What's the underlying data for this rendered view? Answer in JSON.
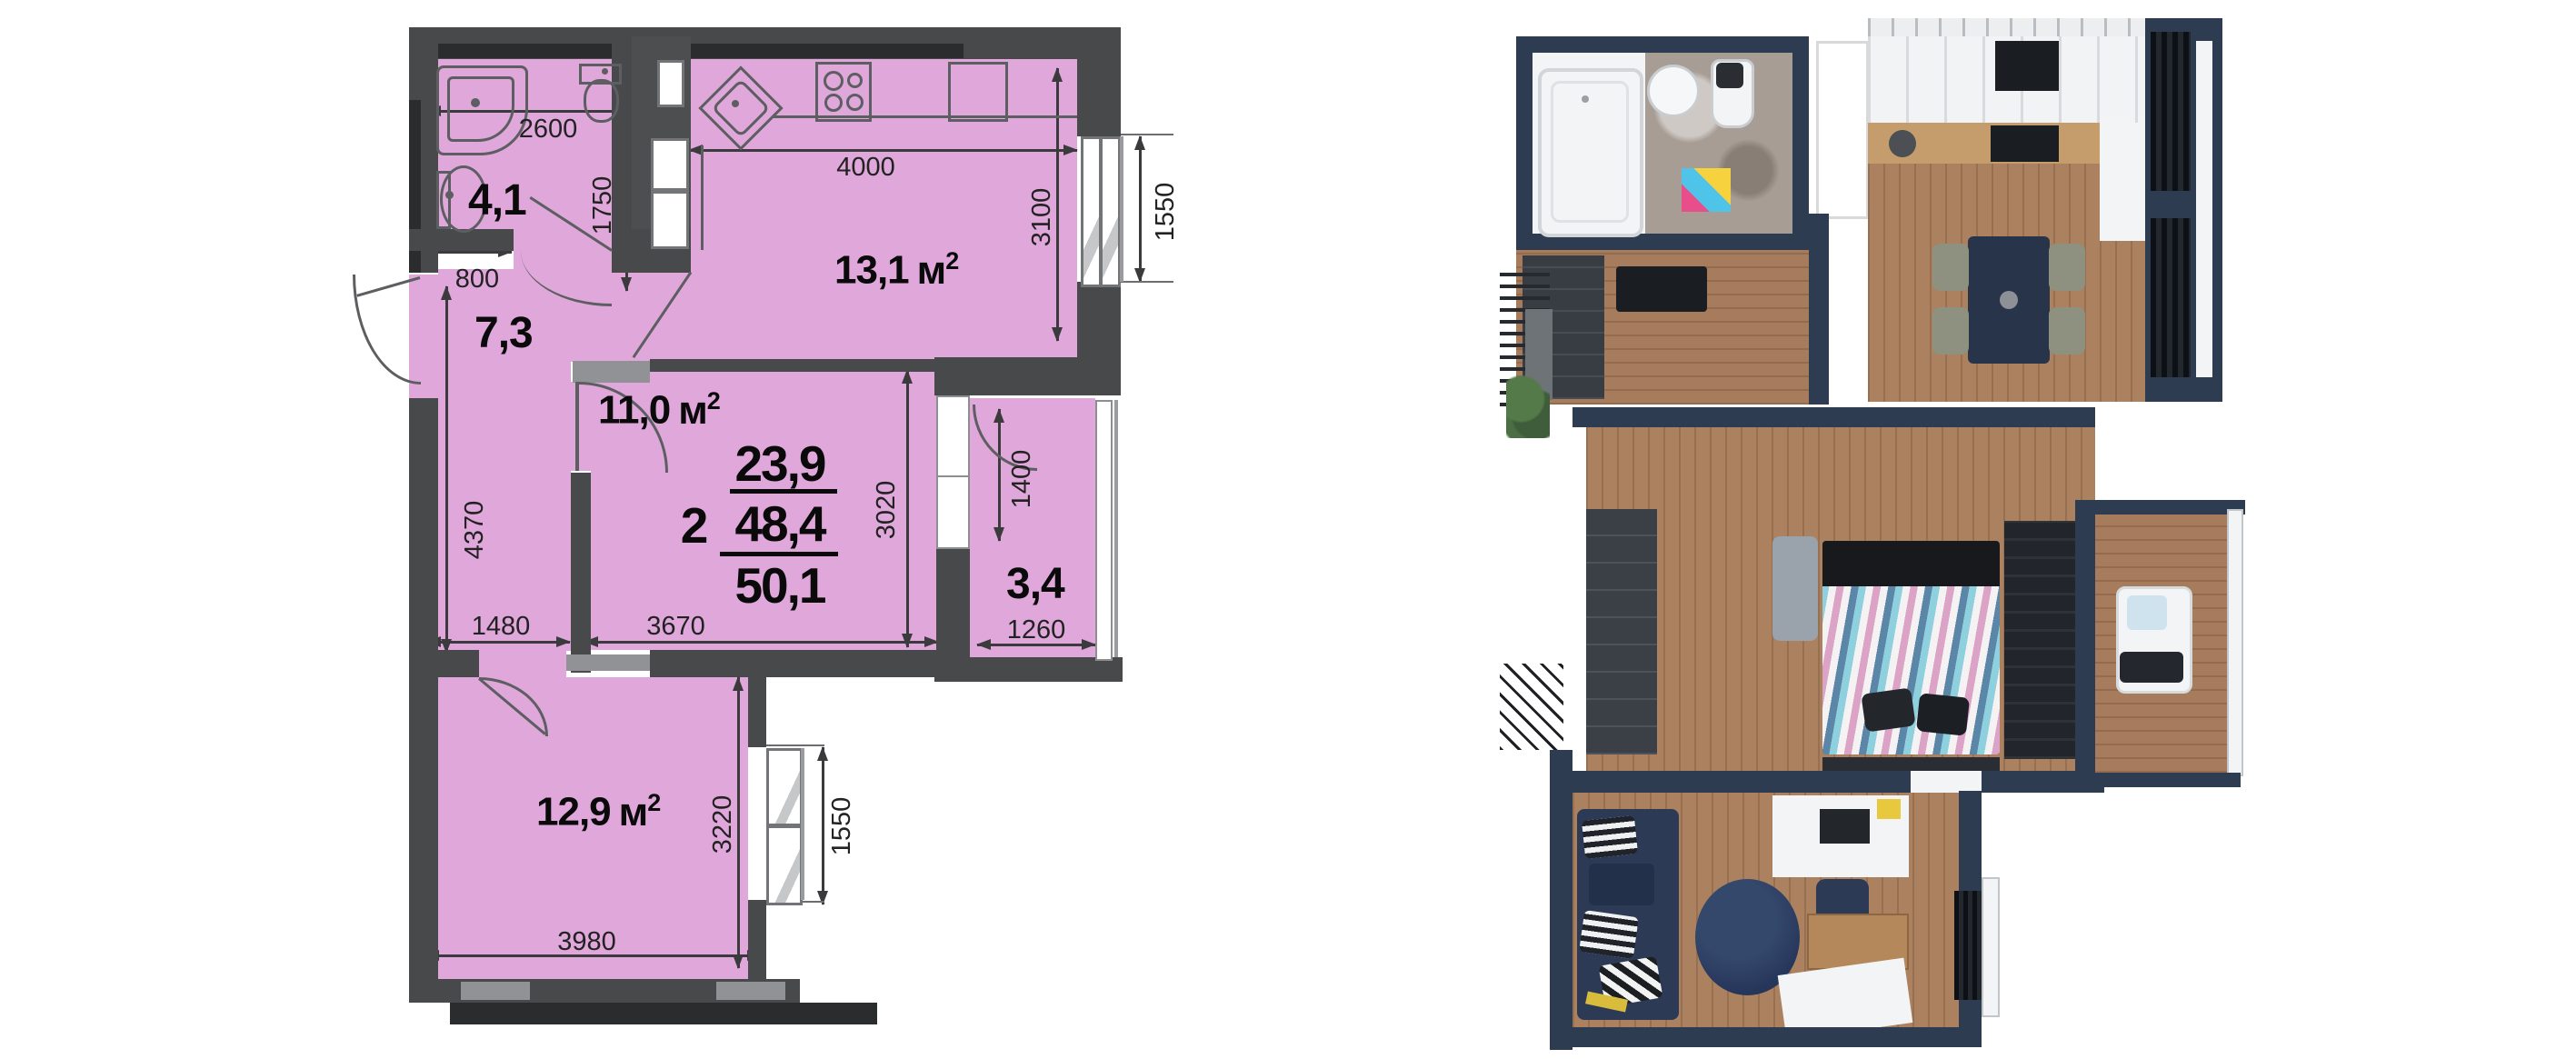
{
  "colors": {
    "plan_room_fill": "#dfa7da",
    "plan_wall": "#48494b",
    "plan_wall_dark": "#2b2c2e",
    "plan_wall_light": "#909296",
    "plan_outline": "#5d5e61",
    "dim_text": "#2c2c2c",
    "area_text": "#0a0a0a",
    "render_wall": "#2e3c52",
    "render_floor": "#ab8160",
    "render_sofa": "#2c3a55",
    "render_counter": "#c59d6d"
  },
  "plan": {
    "rooms": [
      {
        "id": "bathroom",
        "area": "4,1"
      },
      {
        "id": "hallway",
        "area": "7,3"
      },
      {
        "id": "kitchen",
        "area": "13,1",
        "unit": "м",
        "sup": "2"
      },
      {
        "id": "living-room",
        "area": "11,0",
        "unit": "м",
        "sup": "2"
      },
      {
        "id": "balcony",
        "area": "3,4"
      },
      {
        "id": "bedroom",
        "area": "12,9",
        "unit": "м",
        "sup": "2"
      }
    ],
    "summary": {
      "rooms_count": "2",
      "living_area": "23,9",
      "area_without_balcony": "48,4",
      "total_area": "50,1"
    },
    "dims": {
      "bath_width": "2600",
      "bath_depth": "1750",
      "hall_door": "800",
      "kitchen_width": "4000",
      "kitchen_depth": "3100",
      "kitchen_window": "1550",
      "living_depth": "3020",
      "living_width": "3670",
      "balcony_depth": "1400",
      "balcony_width": "1260",
      "hall_depth": "4370",
      "hall_width": "1480",
      "bedroom_depth": "3220",
      "bedroom_window": "1550",
      "bedroom_width": "3980"
    }
  }
}
